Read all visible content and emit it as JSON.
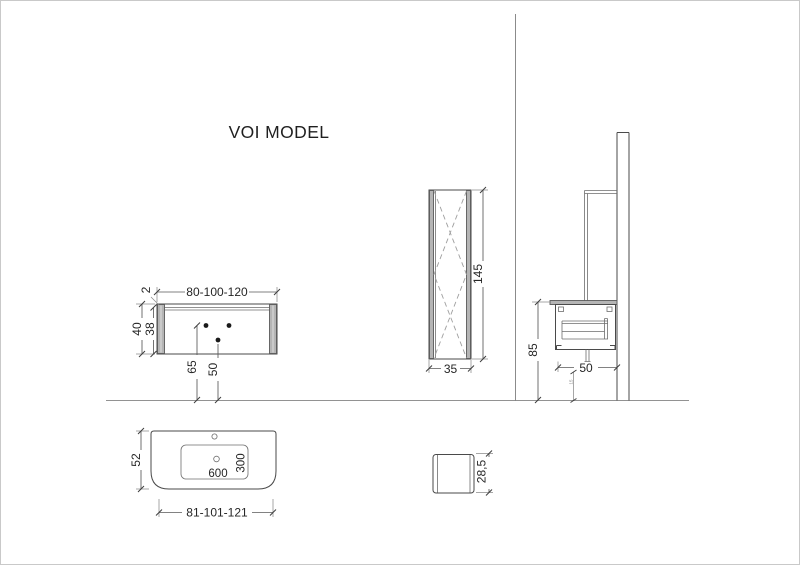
{
  "page": {
    "title": "VOI MODEL"
  },
  "vanity_front": {
    "width_options": "80-100-120",
    "top_thickness": "2",
    "total_height": "40",
    "body_height": "38",
    "supply_holes_height": "65",
    "drain_hole_height": "50"
  },
  "tall_cabinet": {
    "height": "145",
    "depth": "35"
  },
  "side_view": {
    "worktop_height": "85",
    "depth": "50",
    "drain_floor_offset": "15"
  },
  "washbasin_plan": {
    "depth": "52",
    "bowl_width": "600",
    "bowl_depth": "300",
    "width_options": "81-101-121"
  },
  "washbasin_side": {
    "height": "28,5"
  }
}
